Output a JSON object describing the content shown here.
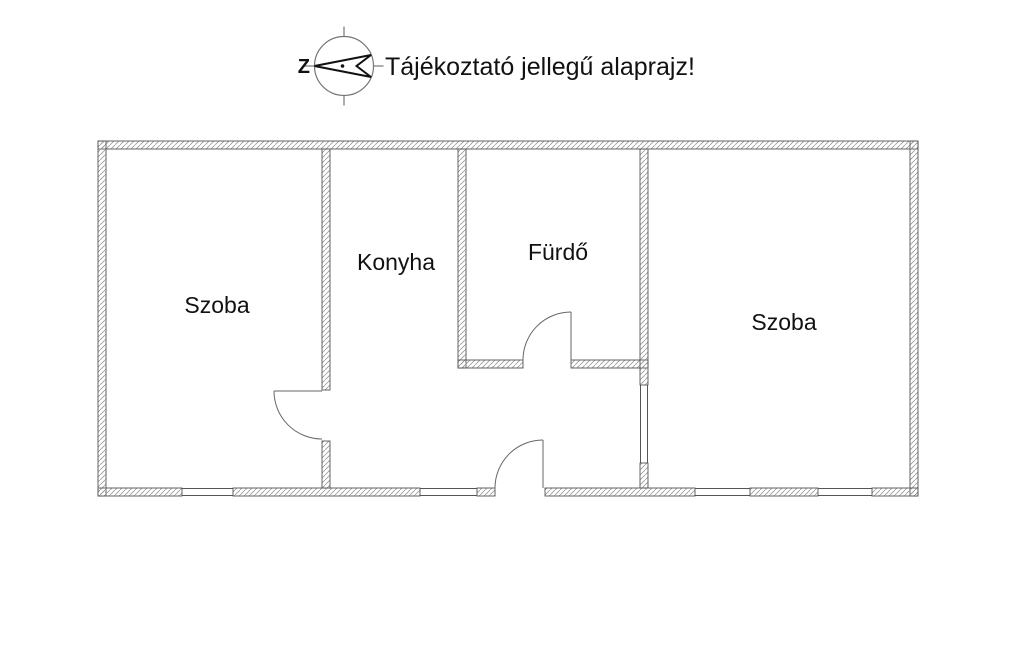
{
  "header": {
    "compass": {
      "north_letter": "Z"
    },
    "title": "Tájékoztató jellegű alaprajz!"
  },
  "floorplan": {
    "rooms": [
      {
        "name": "szoba-left",
        "label": "Szoba"
      },
      {
        "name": "konyha",
        "label": "Konyha"
      },
      {
        "name": "furdo",
        "label": "Fürdő"
      },
      {
        "name": "szoba-right",
        "label": "Szoba"
      }
    ],
    "colors": {
      "background": "#ffffff",
      "wall_outline": "#555555",
      "wall_hatch": "#999999",
      "text": "#111111"
    }
  }
}
